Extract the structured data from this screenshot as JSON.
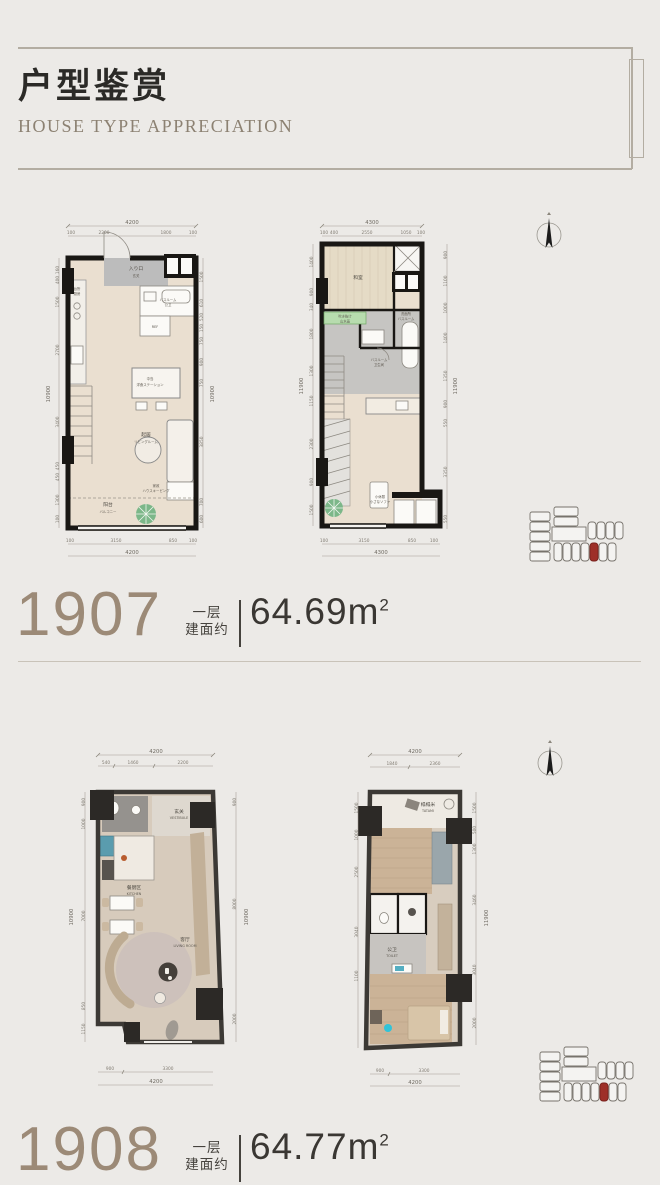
{
  "colors": {
    "background": "#ECEAE7",
    "frame_line": "#B3ADA2",
    "unit_number": "#9C8A77",
    "title_text": "#2B2A27",
    "subtitle_text": "#8C8172",
    "area_text": "#3A3733",
    "wall_black": "#191714",
    "wall_dark_gray": "#3C3935",
    "floor_beige": "#EADFD0",
    "floor_wood": "#CBB397",
    "highlight_red": "#9E2F28",
    "plant_green": "#7CB789"
  },
  "header": {
    "title": "户型鉴赏",
    "subtitle": "HOUSE TYPE APPRECIATION"
  },
  "units": [
    {
      "number": "1907",
      "floor": "一层",
      "about": "建面约",
      "area": "64.69m",
      "sup": "2"
    },
    {
      "number": "1908",
      "floor": "一层",
      "about": "建面约",
      "area": "64.77m",
      "sup": "2"
    }
  ],
  "plans": {
    "p1": {
      "rooms": {
        "entry1": "入り口",
        "entry2": "玄关",
        "kitchen1": "台所",
        "kitchen2": "厨房",
        "bath1": "バスルーム",
        "bath2": "公卫",
        "ref": "REF",
        "island1": "中岛",
        "island2": "洋食ステーション",
        "living1": "起居",
        "living2": "リビングルーム",
        "hk1": "家政",
        "hk2": "ハウスキーピング",
        "balcony1": "阳台",
        "balcony2": "バルコニー"
      },
      "dims": {
        "top_total": "4200",
        "top": [
          "100",
          "2200",
          "1800",
          "100"
        ],
        "left": [
          "160",
          "400",
          "1500",
          "2700",
          "3400",
          "450",
          "450",
          "1300",
          "100"
        ],
        "left_total": "10900",
        "right": [
          "1500",
          "610",
          "520",
          "150",
          "750",
          "900",
          "750",
          "3850",
          "700",
          "600"
        ],
        "right_total": "10900",
        "bottom": [
          "100",
          "3150",
          "850",
          "100"
        ],
        "bottom_total": "4200"
      }
    },
    "p2": {
      "rooms": {
        "tatami": "和室",
        "wash1": "洗面所",
        "wash2": "バスルーム",
        "loft1": "吹き抜け",
        "loft2": "山水画",
        "bath1": "バスルーム",
        "bath2": "卫生间",
        "rest1": "小休憩",
        "rest2": "小さなソファ"
      },
      "dims": {
        "top_total": "4300",
        "top": [
          "100",
          "400",
          "2550",
          "1050",
          "100"
        ],
        "left": [
          "100",
          "1400",
          "100",
          "900",
          "340",
          "1800",
          "1300",
          "1150",
          "2300",
          "900",
          "1500"
        ],
        "left_total": "11900",
        "right": [
          "900",
          "1100",
          "1000",
          "1400",
          "1350",
          "900",
          "550",
          "3350",
          "550"
        ],
        "right_total": "11900",
        "bottom": [
          "100",
          "3150",
          "850",
          "100"
        ],
        "bottom_total": "4300"
      }
    },
    "p3": {
      "rooms": {
        "vest1": "玄关",
        "vest2": "VESTIBULE",
        "kitchen1": "餐厨区",
        "kitchen2": "KITCHEN",
        "living1": "客厅",
        "living2": "LIVING ROOM"
      },
      "dims": {
        "top_total": "4200",
        "top": [
          "540",
          "1460",
          "2200"
        ],
        "left": [
          "900",
          "1000",
          "7000",
          "850",
          "1150"
        ],
        "left_total": "10900",
        "right": [
          "900",
          "8000",
          "2000"
        ],
        "right_total": "10900",
        "bottom": [
          "900",
          "3300"
        ],
        "bottom_total": "4200"
      }
    },
    "p4": {
      "rooms": {
        "tatami1": "榻榻米",
        "tatami2": "TATAMI",
        "toilet1": "公卫",
        "toilet2": "TOILET"
      },
      "dims": {
        "top_total": "4200",
        "top": [
          "1840",
          "2360"
        ],
        "left": [
          "1500",
          "1000",
          "2500",
          "3040",
          "1100"
        ],
        "right": [
          "1500",
          "500",
          "1300",
          "3460",
          "3040",
          "2000"
        ],
        "right_total": "11900",
        "bottom": [
          "900",
          "3300"
        ],
        "bottom_total": "4200"
      }
    }
  }
}
